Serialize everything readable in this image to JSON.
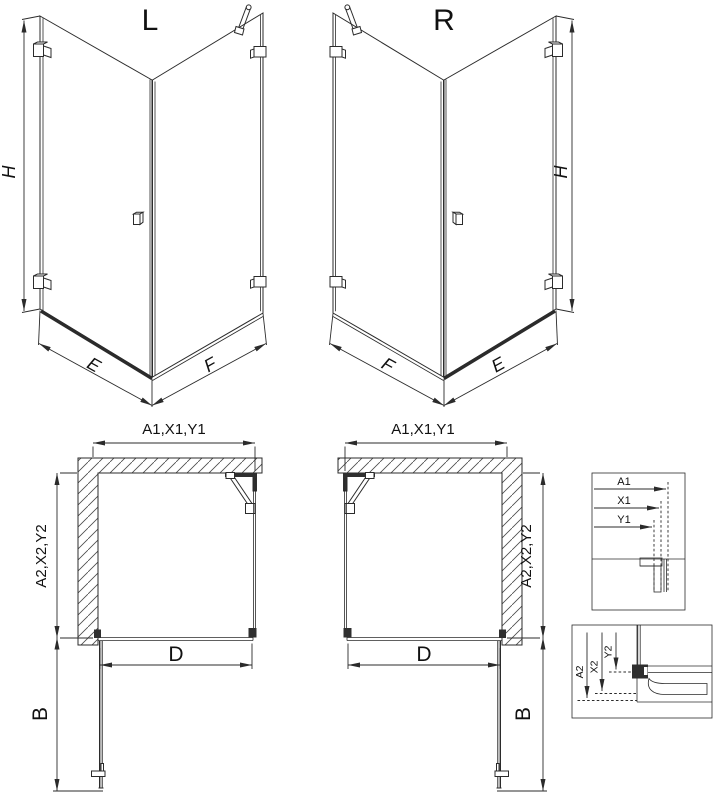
{
  "diagram": {
    "background": "#ffffff",
    "line_color": "#2b2b2b",
    "views": {
      "iso_left": {
        "label": "L",
        "height": "H",
        "front": "E",
        "side": "F"
      },
      "iso_right": {
        "label": "R",
        "height": "H",
        "front": "E",
        "side": "F"
      },
      "plan_left": {
        "width": "A1,X1,Y1",
        "depth": "A2,X2,Y2",
        "entry": "D",
        "door": "B"
      },
      "plan_right": {
        "width": "A1,X1,Y1",
        "depth": "A2,X2,Y2",
        "entry": "D",
        "door": "B"
      },
      "detail_top": {
        "a1": "A1",
        "x1": "X1",
        "y1": "Y1"
      },
      "detail_bottom": {
        "a2": "A2",
        "x2": "X2",
        "y2": "Y2"
      }
    }
  }
}
